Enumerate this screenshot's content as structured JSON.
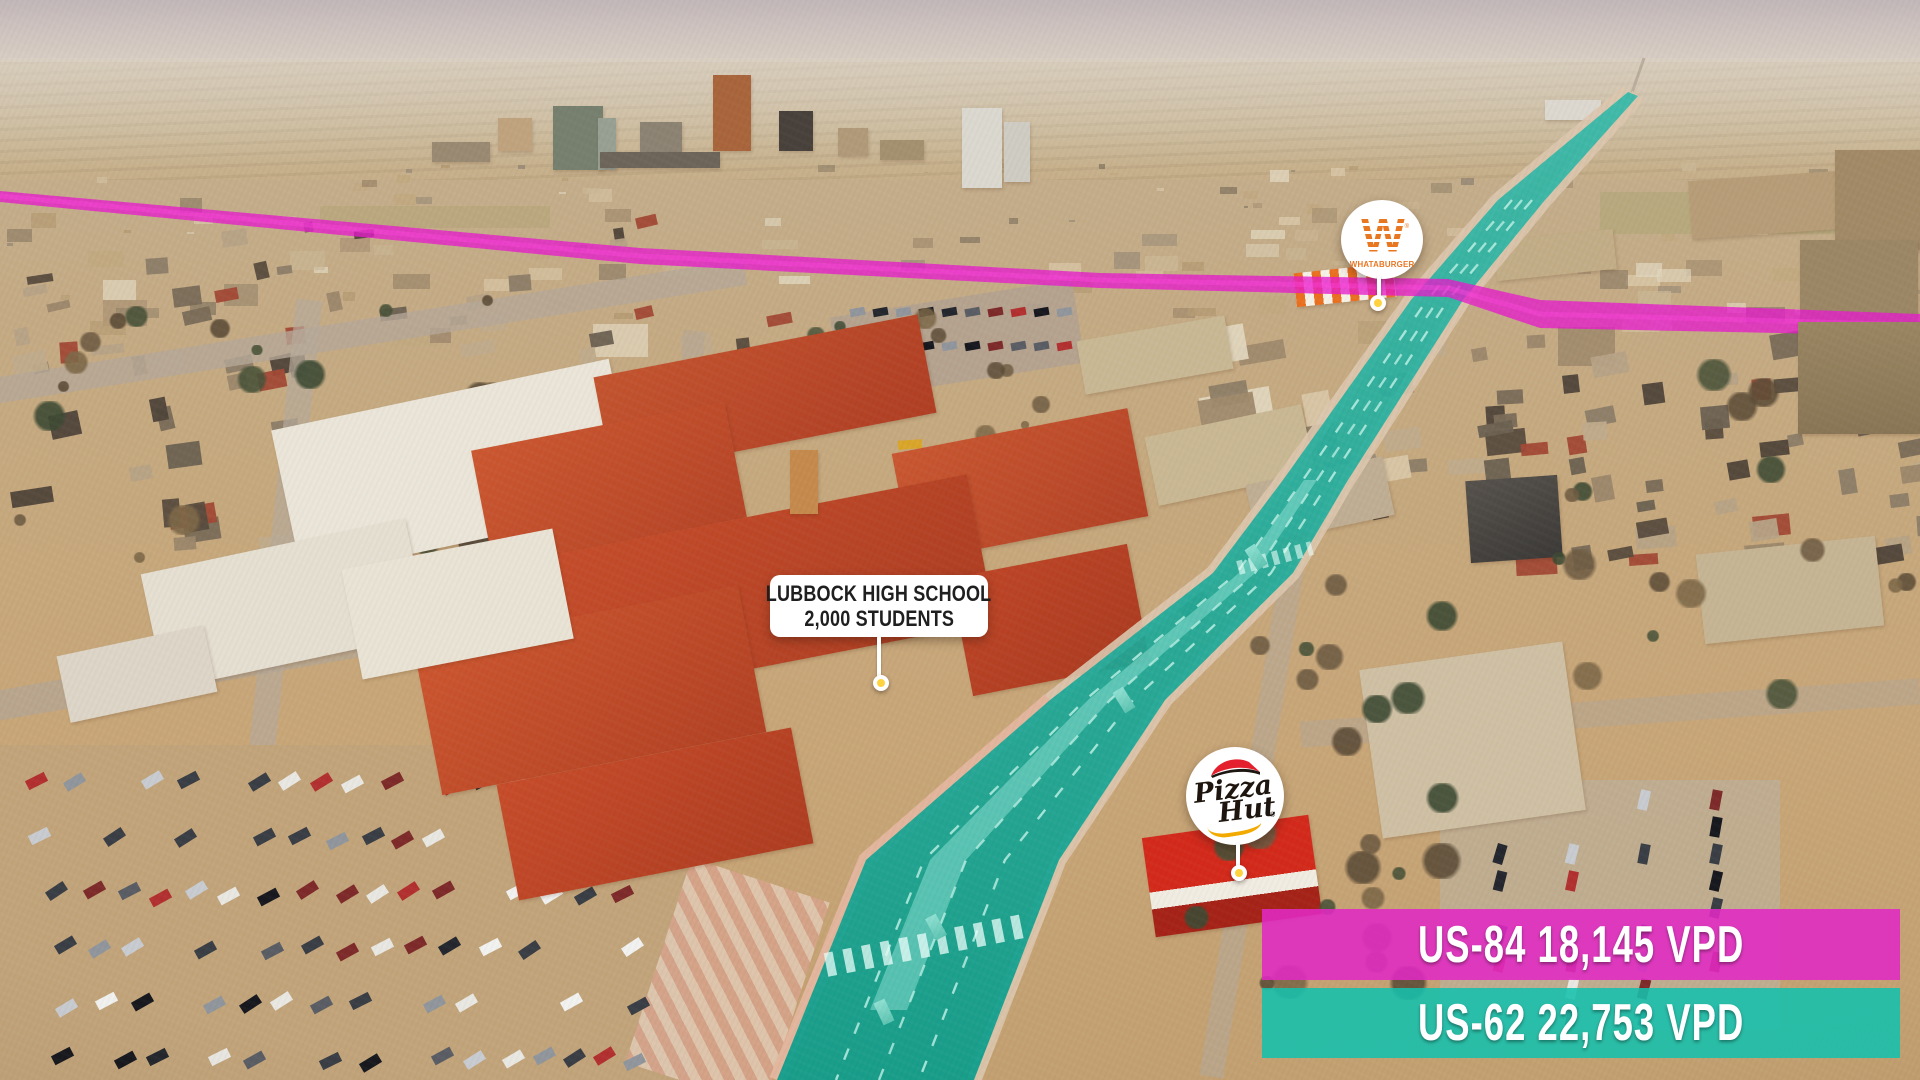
{
  "markers": {
    "school": {
      "line1": "LUBBOCK HIGH SCHOOL",
      "line2": "2,000 STUDENTS"
    },
    "whataburger": {
      "monogram": "W",
      "wordmark": "WHATABURGER",
      "reg": "®"
    },
    "pizza_hut": {
      "word1": "Pizza",
      "word2": "Hut",
      "reg": "®"
    }
  },
  "banners": [
    {
      "id": "us-84",
      "route": "US-84",
      "vpd": "18,145",
      "unit": "VPD",
      "label": "US-84 18,145 VPD",
      "color": "#E129C4"
    },
    {
      "id": "us-62",
      "route": "US-62",
      "vpd": "22,753",
      "unit": "VPD",
      "label": "US-62 22,753 VPD",
      "color": "#14C0AD"
    }
  ],
  "routes": [
    {
      "name": "US-84",
      "highlight_color": "#E51CCB",
      "vpd": 18145
    },
    {
      "name": "US-62",
      "highlight_color": "#0EA695",
      "vpd": 22753
    }
  ],
  "colors": {
    "us84_banner": "rgba(225,41,196,0.88)",
    "us62_banner": "rgba(20,192,173,0.88)",
    "us84_route": "#E51CCB",
    "us62_route": "#0EA695",
    "road_marking": "#B9EFE3",
    "pin_dot_yellow": "#FFD23F",
    "whataburger_orange": "#E87722",
    "pizza_red": "#E5202E",
    "pizza_gold": "#F2A900"
  }
}
